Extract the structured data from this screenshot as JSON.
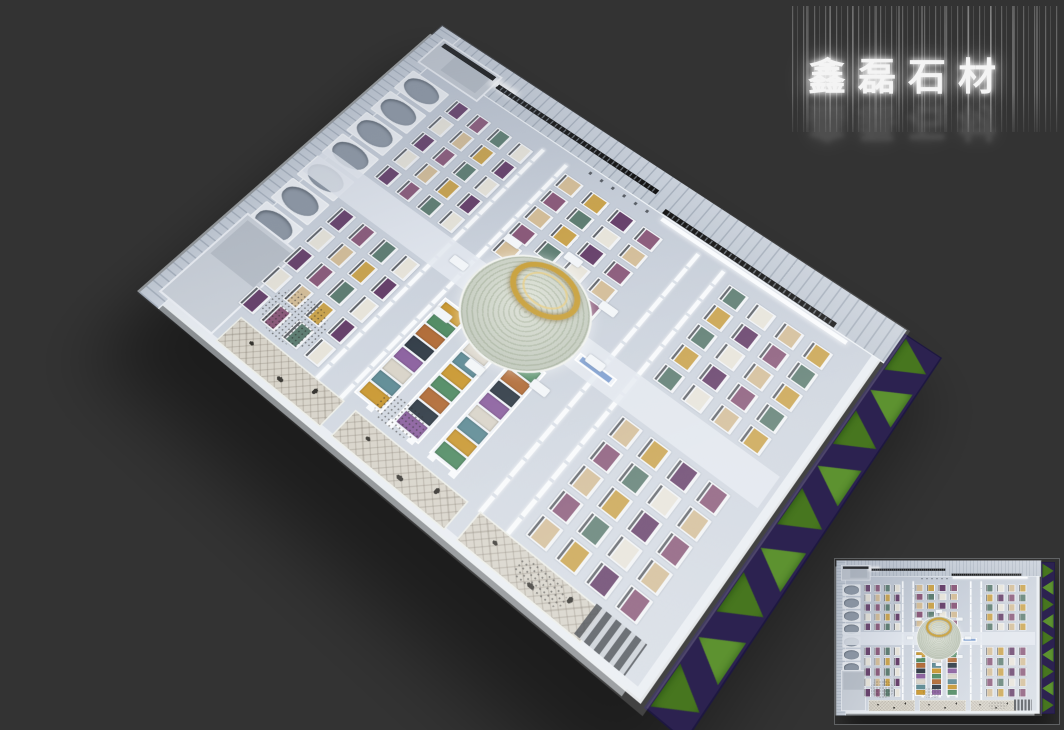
{
  "background_color": "#333333",
  "signage": {
    "text": "鑫磊石材",
    "style": "dot-matrix-led-with-vertical-light-streaks",
    "glow_color": "#ffffff"
  },
  "scene": {
    "subject": "stone slab showroom, axonometric 3D render with top-down minimap",
    "floor_color": "#ccd3dd",
    "aisle_color": "rgba(228,233,240,0.85)",
    "wall_color": "#f8fafc",
    "crane_beam_color": "#141414",
    "bulk_rack_color": "#8d97a4",
    "atrium_base_color": "#c7cec2",
    "gold_ring_color": "#c9a23f",
    "mosaic_floor_color": "#d7d3c9",
    "rack_palette": [
      "#66406a",
      "#c9a34e",
      "#d3bd98",
      "#e7e4da",
      "#5e7d72",
      "#8a5a7a"
    ],
    "block_palette": [
      "#c9972f",
      "#8a5f9e",
      "#4f8a62",
      "#d8d3c8",
      "#b06a35",
      "#5d8a94",
      "#2f3a45"
    ],
    "lawn": {
      "grass_colors": [
        "#47761f",
        "#5d9230"
      ],
      "path_color": "#2c2250"
    },
    "bays": {
      "rack_rows": 5,
      "rack_cols": 4,
      "rack_bay_count": 5
    },
    "counts": {
      "bulk_racks": 9,
      "green_triangles": 9,
      "block_strips": 3,
      "blocks_per_strip": 8,
      "atrium_stands": 8
    }
  },
  "minimap": {
    "border_color": "rgba(180,185,192,0.35)"
  }
}
